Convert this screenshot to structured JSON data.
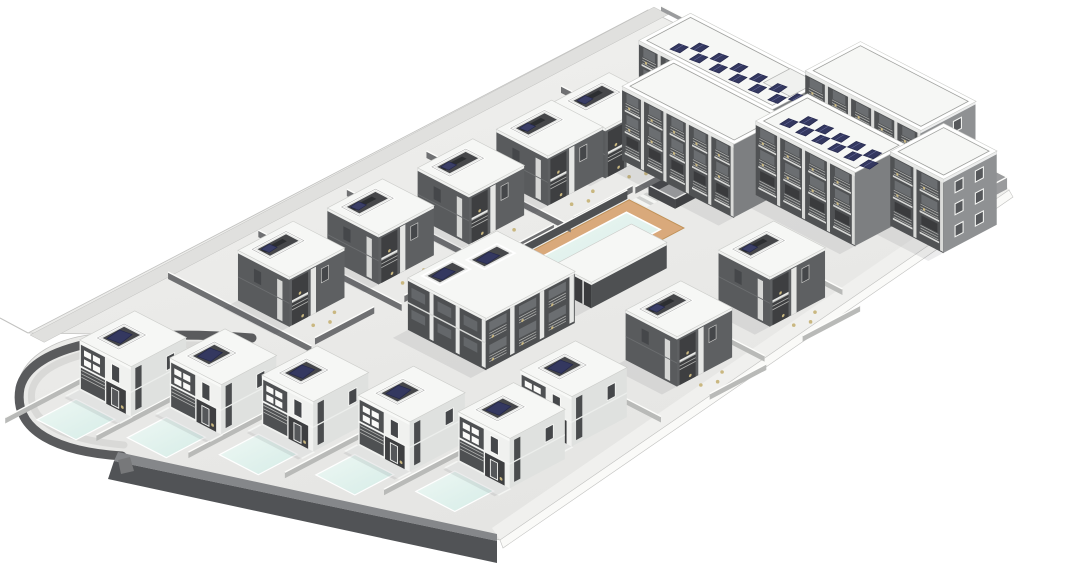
{
  "scene": {
    "width": 1079,
    "height": 576,
    "background": "#ffffff",
    "description": "axonometric-3d-render-of-residential-complex-with-villas-pool-and-apartment-building"
  },
  "palette": {
    "ground_light": "#f1f1ef",
    "ground_dark": "#e5e5e3",
    "road": "#e0e0de",
    "se_band": "#f0f0ee",
    "se_fascia": "#fafaf8",
    "edge_line": "#c2c2c0",
    "wall_dark": "#515356",
    "wall_top": "#85878a",
    "culdesac_dark": "#5a5b5d",
    "culdesac_road": "#d9d9d7",
    "roof_white": "#f6f7f5",
    "roof_edge": "#cdcecb",
    "villa_white": "#f0f1ef",
    "villa_shade": "#dfe1df",
    "facade_dark": "#4e5052",
    "facade_dark2": "#595b5d",
    "recess_dark": "#3e3f41",
    "window_dark": "#45474a",
    "window_frame": "#fafaf8",
    "railing": "#b3b4b2",
    "pier_white": "#e6e7e5",
    "slab_white": "#f4f5f3",
    "solar_navy": "#343860",
    "solar_edge": "#23264b",
    "solar_line": "#6a6fa0",
    "deck_tan": "#d9a97b",
    "deck_edge": "#c09258",
    "water_light": "#eef8f4",
    "water_dark": "#d6ece7",
    "coping": "#ffffff",
    "furniture": "#c9b780",
    "court_floor": "#9fa0a2",
    "court_wall": "#46474a",
    "divider_light": "#b9bab8",
    "divider_dark": "#6f7072",
    "parapet_face": "#9a9b9d",
    "shadow": "rgba(70,72,78,0.10)",
    "end_face": "#8f9193",
    "apt_bay": "#4a4c4e",
    "apt_window": "#6b6e71",
    "apt_ground": "#3a3b3d"
  },
  "iso": {
    "origin": [
      30,
      335
    ],
    "e1": [
      0.885,
      -0.465
    ],
    "e2": [
      0.885,
      0.456
    ]
  },
  "terrain": {
    "outline": "M 648,10 L 1009,190 L 500,540 L 122,456 C 55,452 10,430 18,386 C 22,355 60,336 100,334 L 28,333 Z",
    "lip_line": [
      [
        0,
        318
      ],
      [
        28,
        333
      ]
    ],
    "nw_road": {
      "u0": 0,
      "u1": 705,
      "v0": 0,
      "v1": 16
    },
    "se_band": [
      [
        1009,
        190
      ],
      [
        500,
        540
      ],
      [
        492,
        528
      ],
      [
        1001,
        178
      ]
    ],
    "se_fascia": [
      [
        1009,
        190
      ],
      [
        500,
        540
      ],
      [
        503,
        548
      ],
      [
        1013,
        197
      ]
    ],
    "front_wall_top": [
      [
        118,
        452
      ],
      [
        497,
        534
      ],
      [
        497,
        541
      ],
      [
        114,
        461
      ]
    ],
    "front_wall_face": [
      [
        114,
        461
      ],
      [
        497,
        541
      ],
      [
        497,
        563
      ],
      [
        108,
        479
      ]
    ],
    "culdesac_outer": "M 252,338 C 120,328 30,345 20,388 C 12,432 60,452 122,456",
    "culdesac_inner": "M 252,348 C 130,338 42,352 32,390 C 26,424 68,440 124,445",
    "culvert": [
      [
        118,
        460
      ],
      [
        130,
        457
      ],
      [
        134,
        471
      ],
      [
        121,
        474
      ]
    ]
  },
  "pool_area": {
    "deck": {
      "u": 272,
      "v": 195,
      "a": 210,
      "b": 62
    },
    "water": {
      "u": 287,
      "v": 207,
      "a": 180,
      "b": 38
    },
    "steps": {
      "u": 484,
      "v": 197,
      "n": 4,
      "w": 4,
      "depth": 16
    }
  },
  "sunken_court": {
    "u": 498,
    "v": 201,
    "a": 75,
    "b": 30,
    "h": 10
  },
  "villa_spec": {
    "a": 62,
    "b": 58,
    "h": 50,
    "box_front": {
      "x": 12,
      "y": 8,
      "w": 30,
      "h": 24
    },
    "box_court": {
      "x": 9,
      "y": 7,
      "w": 38,
      "h": 20
    },
    "pool": {
      "dx": -56,
      "dy": 8,
      "a": 44,
      "b": 44
    }
  },
  "villas": [
    {
      "id": "villa-back-1",
      "u": 154,
      "v": 81,
      "variant": "court"
    },
    {
      "id": "villa-back-2",
      "u": 250,
      "v": 86,
      "variant": "court"
    },
    {
      "id": "villa-back-3",
      "u": 344,
      "v": 94,
      "variant": "court"
    },
    {
      "id": "villa-back-4",
      "u": 430,
      "v": 97,
      "variant": "court"
    },
    {
      "id": "villa-back-5",
      "u": 492,
      "v": 100,
      "variant": "court"
    },
    {
      "id": "villa-east-1",
      "u": 423,
      "v": 355,
      "variant": "court"
    },
    {
      "id": "villa-east-2",
      "u": 306,
      "v": 367,
      "variant": "court"
    },
    {
      "id": "villa-front-6",
      "u": 182,
      "v": 372,
      "variant": "front",
      "pool": true
    },
    {
      "id": "villa-front-1",
      "u": -32,
      "v": 88,
      "variant": "front",
      "pool": true
    },
    {
      "id": "villa-front-2",
      "u": -1,
      "v": 159,
      "variant": "front",
      "pool": true
    },
    {
      "id": "villa-front-3",
      "u": 32,
      "v": 230,
      "variant": "front",
      "pool": true
    },
    {
      "id": "villa-front-4",
      "u": 64,
      "v": 307,
      "variant": "front",
      "pool": true
    },
    {
      "id": "villa-front-5",
      "u": 102,
      "v": 382,
      "variant": "front",
      "pool": true
    }
  ],
  "townhouse": {
    "id": "townhouse-block",
    "u": 217,
    "v": 210,
    "a": 100,
    "b": 88,
    "h": 52,
    "bays": 3,
    "boxes": [
      {
        "x": 10,
        "y": 6,
        "w": 34,
        "h": 20
      },
      {
        "x": 52,
        "y": 14,
        "w": 34,
        "h": 20
      }
    ]
  },
  "poolhouse": {
    "id": "pool-house",
    "u": 343,
    "v": 251,
    "a": 85,
    "b": 40,
    "h": 26
  },
  "apartment": {
    "floors": 3,
    "blocks": [
      {
        "id": "apartment-north-wing",
        "u": 580,
        "v": 108,
        "a": 58,
        "b": 150,
        "h": 74,
        "bays": 6,
        "solar": {
          "count": 12,
          "x": 8,
          "y": 26,
          "stepy": 11,
          "zig": 12
        },
        "penthouse": {
          "x": 24,
          "y": 116,
          "w": 30,
          "h": 30
        }
      },
      {
        "id": "apartment-northeast-wing",
        "u": 636,
        "v": 240,
        "a": 62,
        "b": 130,
        "h": 78,
        "bays": 5,
        "end": true
      },
      {
        "id": "apartment-west-wing",
        "u": 521,
        "v": 148,
        "a": 58,
        "b": 126,
        "h": 74,
        "bays": 5
      },
      {
        "id": "apartment-east-wing",
        "u": 558,
        "v": 262,
        "a": 58,
        "b": 112,
        "h": 74,
        "bays": 4,
        "solar": {
          "count": 11,
          "x": 10,
          "y": 16,
          "stepy": 9,
          "zig": 13
        }
      },
      {
        "id": "apartment-end-block",
        "u": 600,
        "v": 372,
        "a": 60,
        "b": 60,
        "h": 74,
        "bays": 2,
        "end": true
      }
    ]
  },
  "walls": [
    {
      "p": [
        [
          138,
          18
        ],
        [
          138,
          180
        ]
      ],
      "h": 7,
      "c": "divider_dark"
    },
    {
      "p": [
        [
          234,
          24
        ],
        [
          234,
          186
        ]
      ],
      "h": 7,
      "c": "divider_dark"
    },
    {
      "p": [
        [
          328,
          30
        ],
        [
          328,
          194
        ]
      ],
      "h": 7,
      "c": "divider_dark"
    },
    {
      "p": [
        [
          414,
          34
        ],
        [
          414,
          197
        ]
      ],
      "h": 7,
      "c": "divider_dark"
    },
    {
      "p": [
        [
          560,
          40
        ],
        [
          560,
          200
        ]
      ],
      "h": 7,
      "c": "divider_dark"
    },
    {
      "p": [
        [
          149,
          173
        ],
        [
          216,
          173
        ]
      ],
      "h": 7,
      "c": "divider_dark"
    },
    {
      "p": [
        [
          245,
          178
        ],
        [
          312,
          178
        ]
      ],
      "h": 7,
      "c": "divider_dark"
    },
    {
      "p": [
        [
          339,
          186
        ],
        [
          406,
          186
        ]
      ],
      "h": 7,
      "c": "divider_dark"
    },
    {
      "p": [
        [
          425,
          189
        ],
        [
          492,
          189
        ]
      ],
      "h": 7,
      "c": "divider_dark"
    },
    {
      "p": [
        [
          492,
          192
        ],
        [
          559,
          192
        ]
      ],
      "h": 7,
      "c": "divider_dark"
    },
    {
      "p": [
        [
          272,
          193
        ],
        [
          482,
          193
        ]
      ],
      "h": 9,
      "c": "facade_dark"
    },
    {
      "p": [
        [
          -110,
          82
        ],
        [
          30,
          82
        ]
      ],
      "h": 6,
      "c": "divider_light"
    },
    {
      "p": [
        [
          -78,
          153
        ],
        [
          61,
          153
        ]
      ],
      "h": 6,
      "c": "divider_light"
    },
    {
      "p": [
        [
          -45,
          224
        ],
        [
          94,
          224
        ]
      ],
      "h": 6,
      "c": "divider_light"
    },
    {
      "p": [
        [
          -13,
          301
        ],
        [
          126,
          301
        ]
      ],
      "h": 6,
      "c": "divider_light"
    },
    {
      "p": [
        [
          24,
          376
        ],
        [
          164,
          376
        ]
      ],
      "h": 6,
      "c": "divider_light"
    },
    {
      "p": [
        [
          258,
          360
        ],
        [
          258,
          455
        ]
      ],
      "h": 6,
      "c": "divider_light"
    },
    {
      "p": [
        [
          382,
          352
        ],
        [
          382,
          448
        ]
      ],
      "h": 6,
      "c": "divider_light"
    },
    {
      "p": [
        [
          498,
          345
        ],
        [
          498,
          420
        ]
      ],
      "h": 6,
      "c": "divider_light"
    },
    {
      "p": [
        [
          310,
          458
        ],
        [
          374,
          458
        ]
      ],
      "h": 6,
      "c": "divider_light"
    },
    {
      "p": [
        [
          425,
          448
        ],
        [
          490,
          448
        ]
      ],
      "h": 6,
      "c": "divider_light"
    },
    {
      "p": [
        [
          705,
          8
        ],
        [
          705,
          300
        ]
      ],
      "h": 5,
      "c": "parapet_face"
    },
    {
      "p": [
        [
          705,
          302
        ],
        [
          705,
          399
        ]
      ],
      "h": 12,
      "c": "parapet_face"
    },
    {
      "p": [
        [
          622,
          399
        ],
        [
          705,
          399
        ]
      ],
      "h": 12,
      "c": "parapet_face"
    }
  ],
  "patio_dot_offsets": [
    [
      15,
      70
    ],
    [
      28,
      76
    ],
    [
      41,
      68
    ]
  ]
}
